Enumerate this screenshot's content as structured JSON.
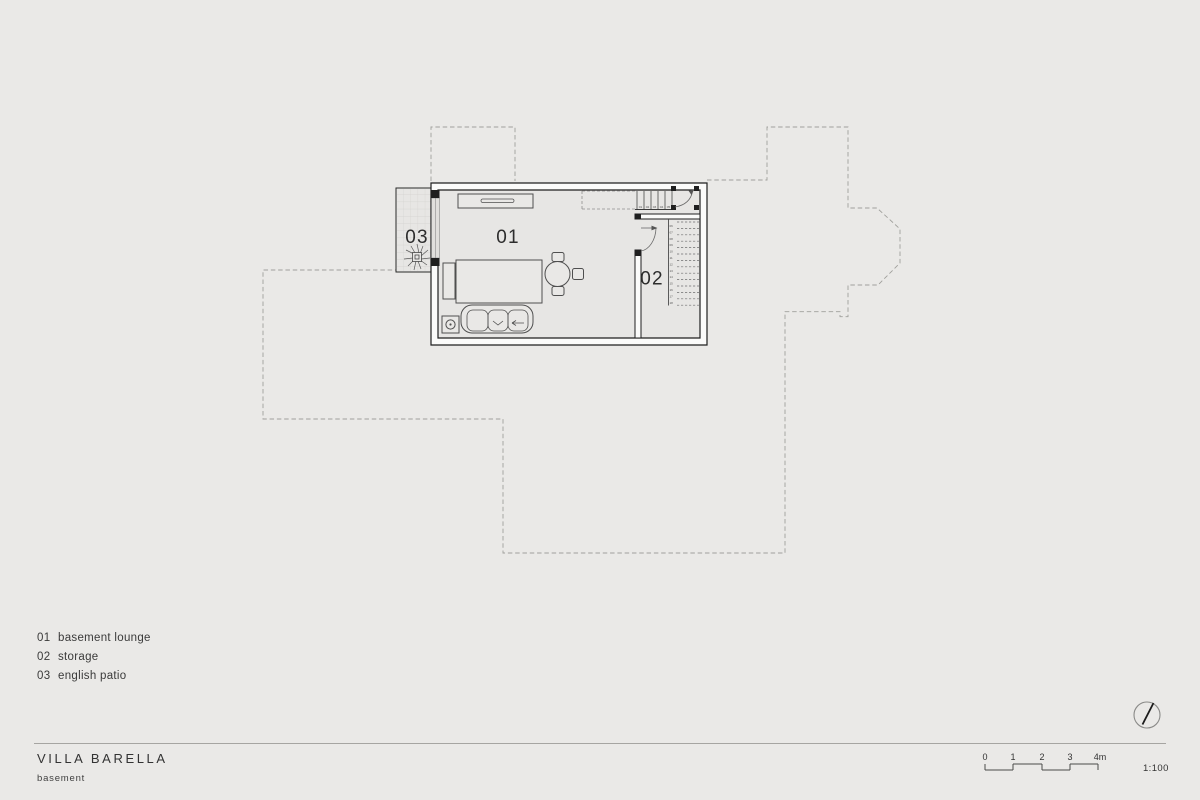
{
  "page": {
    "background_color": "#eae9e7",
    "plan_floor_color": "#e7e6e4",
    "wall_fill_color": "#fbfbfa",
    "wall_line_color": "#1f1f1f",
    "dashed_outline_color": "#a0a09c"
  },
  "title_block": {
    "project": "VILLA BARELLA",
    "sheet": "basement"
  },
  "legend": {
    "items": [
      {
        "number": "01",
        "label": "basement lounge"
      },
      {
        "number": "02",
        "label": "storage"
      },
      {
        "number": "03",
        "label": "english patio"
      }
    ]
  },
  "floor_plan": {
    "room_labels": [
      "01",
      "02",
      "03"
    ],
    "stairs": {
      "upper_run_numbers": [
        "01",
        "02",
        "03",
        "04",
        "05"
      ],
      "lower_run_numbers": [
        "06",
        "07",
        "08",
        "09",
        "10",
        "11",
        "12",
        "13",
        "14",
        "15",
        "16",
        "17",
        "18"
      ]
    }
  },
  "scale_bar": {
    "ticks": [
      "0",
      "1",
      "2",
      "3",
      "4m"
    ],
    "ratio": "1:100"
  }
}
